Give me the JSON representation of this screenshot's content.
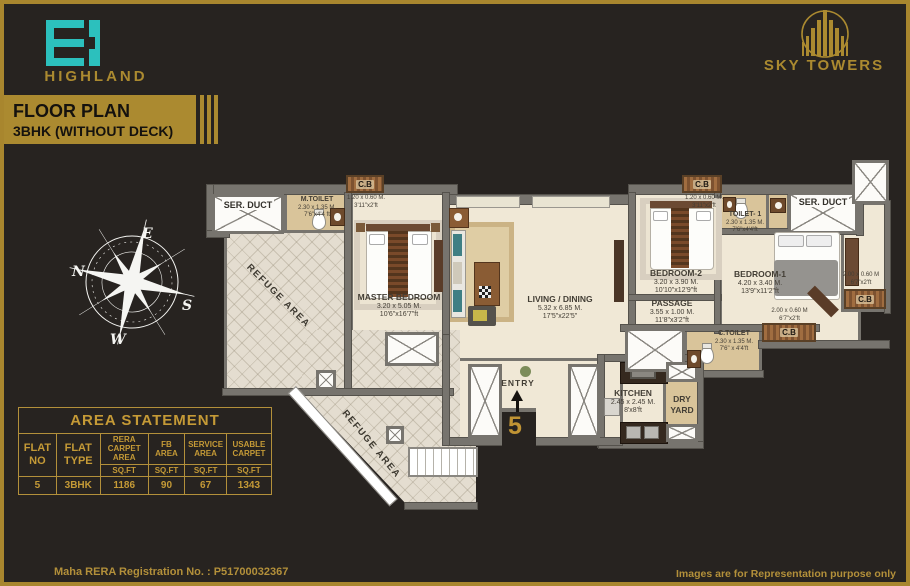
{
  "header": {
    "brand": "HIGHLAND",
    "banner_line1": "FLOOR PLAN",
    "banner_line2": "3BHK (WITHOUT DECK)",
    "right_brand": "SKY TOWERS"
  },
  "compass": {
    "n": "N",
    "e": "E",
    "s": "S",
    "w": "W"
  },
  "plan": {
    "rooms": {
      "master_bedroom": {
        "name": "MASTER BEDROOM",
        "dim_m": "3.20 x 5.05 M.",
        "dim_ft": "10'6\"x16'7\"ft"
      },
      "living_dining": {
        "name": "LIVING / DINING",
        "dim_m": "5.32 x 6.85 M.",
        "dim_ft": "17'5\"x22'5\""
      },
      "bedroom_2": {
        "name": "BEDROOM-2",
        "dim_m": "3.20 x 3.90 M.",
        "dim_ft": "10'10\"x12'9\"ft"
      },
      "bedroom_1": {
        "name": "BEDROOM-1",
        "dim_m": "4.20 x 3.40 M.",
        "dim_ft": "13'9\"x11'2\"ft"
      },
      "passage": {
        "name": "PASSAGE",
        "dim_m": "3.55 x 1.00 M.",
        "dim_ft": "11'8\"x3'2\"ft"
      },
      "kitchen": {
        "name": "KITCHEN",
        "dim_m": "2.45 x 2.45 M.",
        "dim_ft": "8'x8'ft"
      },
      "dry_yard": {
        "name": "DRY YARD"
      },
      "m_toilet": {
        "name": "M.TOILET",
        "dim_m": "2.30 x 1.35 M.",
        "dim_ft": "7'6\"x4'4 ft"
      },
      "toilet_1": {
        "name": "TOILET- 1",
        "dim_m": "2.30 x 1.35 M.",
        "dim_ft": "7'6\"x4'4'ft"
      },
      "c_toilet": {
        "name": "C.TOILET",
        "dim_m": "2.30 x 1.35 M.",
        "dim_ft": "7'6\" x 4'4'ft"
      },
      "ser_duct_left": {
        "name": "SER. DUCT"
      },
      "ser_duct_right": {
        "name": "SER. DUCT"
      },
      "refuge_area_1": {
        "name": "REFUGE AREA"
      },
      "refuge_area_2": {
        "name": "REFUGE AREA"
      },
      "cb_master": {
        "name": "C.B",
        "dim_m": "1.20 x 0.60 M.",
        "dim_ft": "3'11\"x2'ft"
      },
      "cb_bedroom2": {
        "name": "C.B",
        "dim_m": "1.20 x 0.60 M.",
        "dim_ft": "3'11\"x2'ft"
      },
      "cb_bottom": {
        "name": "C.B",
        "dim_m": "2.00 x 0.60 M",
        "dim_ft": "6'7\"x2'ft"
      },
      "cb_right": {
        "name": "C.B",
        "dim_m": "2.00 x 0.60 M",
        "dim_ft": "6'7\"x2'ft"
      }
    },
    "entry": {
      "label": "ENTRY",
      "flat_number": "5"
    }
  },
  "area_statement": {
    "title": "AREA STATEMENT",
    "columns": [
      {
        "label": "FLAT NO",
        "unit": ""
      },
      {
        "label": "FLAT TYPE",
        "unit": ""
      },
      {
        "label": "RERA CARPET AREA",
        "unit": "SQ.FT"
      },
      {
        "label": "FB AREA",
        "unit": "SQ.FT"
      },
      {
        "label": "SERVICE AREA",
        "unit": "SQ.FT"
      },
      {
        "label": "USABLE CARPET",
        "unit": "SQ.FT"
      }
    ],
    "row": [
      "5",
      "3BHK",
      "1186",
      "90",
      "67",
      "1343"
    ]
  },
  "footer": {
    "left": "Maha RERA Registration No. : P51700032367",
    "right": "Images are for Representation purpose only"
  },
  "colors": {
    "gold": "#ab8a30",
    "teal": "#2cc0bd",
    "background": "#272320",
    "floor": "#f0e8d6",
    "wall": "#77746e"
  }
}
